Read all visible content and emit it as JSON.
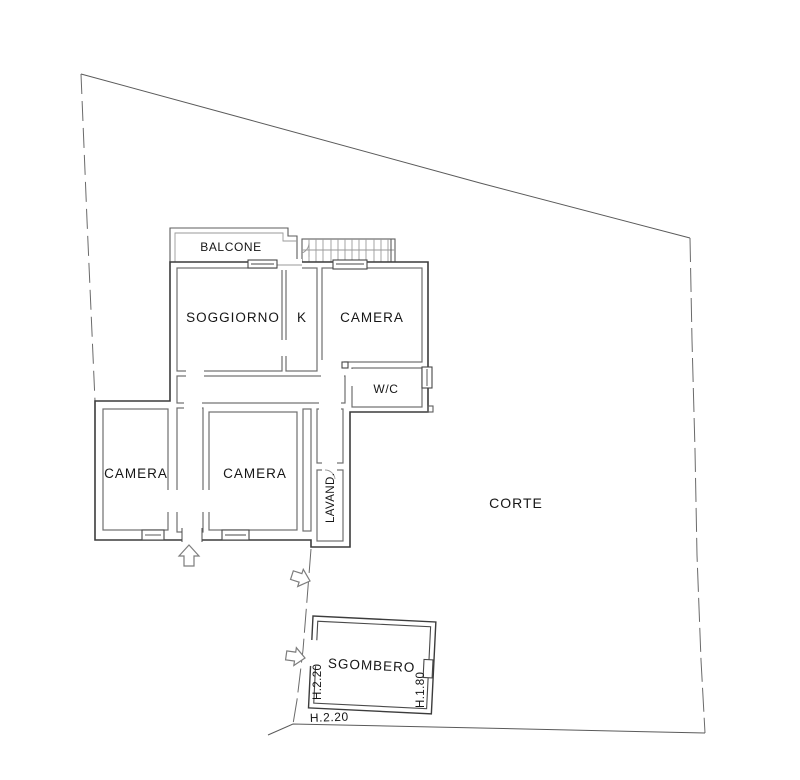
{
  "plan": {
    "type": "floor-plan",
    "rooms": {
      "balcone": "BALCONE",
      "soggiorno": "SOGGIORNO",
      "kitchen": "K",
      "camera_top": "CAMERA",
      "wc": "W/C",
      "camera_left": "CAMERA",
      "camera_right": "CAMERA",
      "lavanderia": "LAVAND.",
      "corte": "CORTE",
      "sgombero": "SGOMBERO"
    },
    "dimensions": {
      "sgombero_left": "H.2.20",
      "sgombero_right": "H.1.80",
      "sgombero_bottom": "H.2.20"
    },
    "colors": {
      "wall": "#3c3c3c",
      "partition": "#6e6e6e",
      "boundary": "#5a5a5a",
      "text": "#161616",
      "background": "#ffffff"
    }
  }
}
